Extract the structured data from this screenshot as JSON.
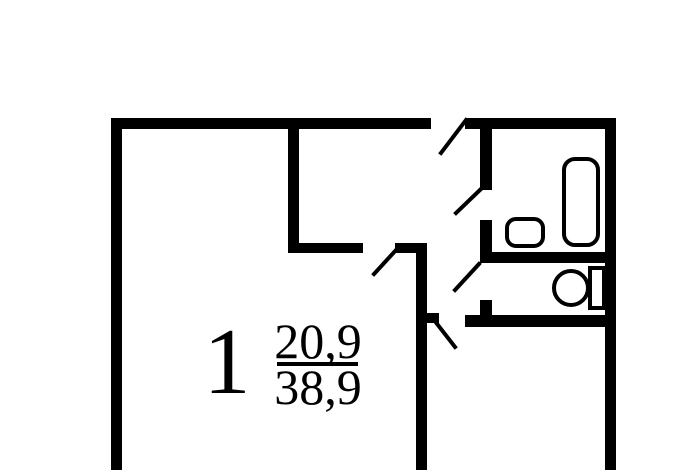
{
  "colors": {
    "wall": "#000000",
    "background": "#ffffff"
  },
  "room_label": {
    "number": "1",
    "living_area": "20,9",
    "total_area": "38,9"
  },
  "icons": {
    "bathtub": "bathtub-icon",
    "sink": "sink-icon",
    "toilet_bowl": "toilet-bowl-icon",
    "toilet_tank": "toilet-tank-icon"
  }
}
